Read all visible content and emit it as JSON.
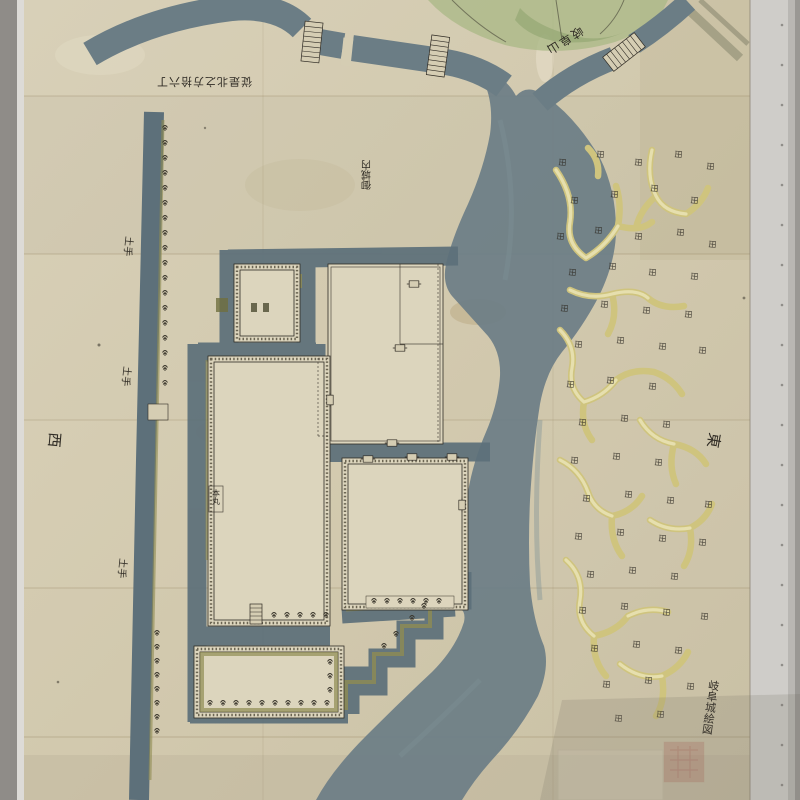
{
  "map": {
    "description": "hand-drawn Edo-period castle map scan",
    "labels": {
      "distance_note": "従是北之方拾六丁",
      "mountain_name": "岐阜山",
      "moat_note": "御城内",
      "levee_label": "土手",
      "direction_west": "西",
      "direction_east": "東",
      "inner_bailey_label": "本丸",
      "paddy_mark": "田",
      "title_inscription": "岐阜城絵図"
    },
    "colors": {
      "paper": "#d5cdb3",
      "court": "#dcd5bd",
      "water": "#6b7d85",
      "moat": "#5d707a",
      "green": "#8f8c52",
      "channel": "#cfc47e",
      "channelCore": "#e6dfae",
      "mountain": "#a9b886",
      "ink": "#2f2b24",
      "inkSoft": "#57513f",
      "seal": "#b05a50"
    }
  }
}
